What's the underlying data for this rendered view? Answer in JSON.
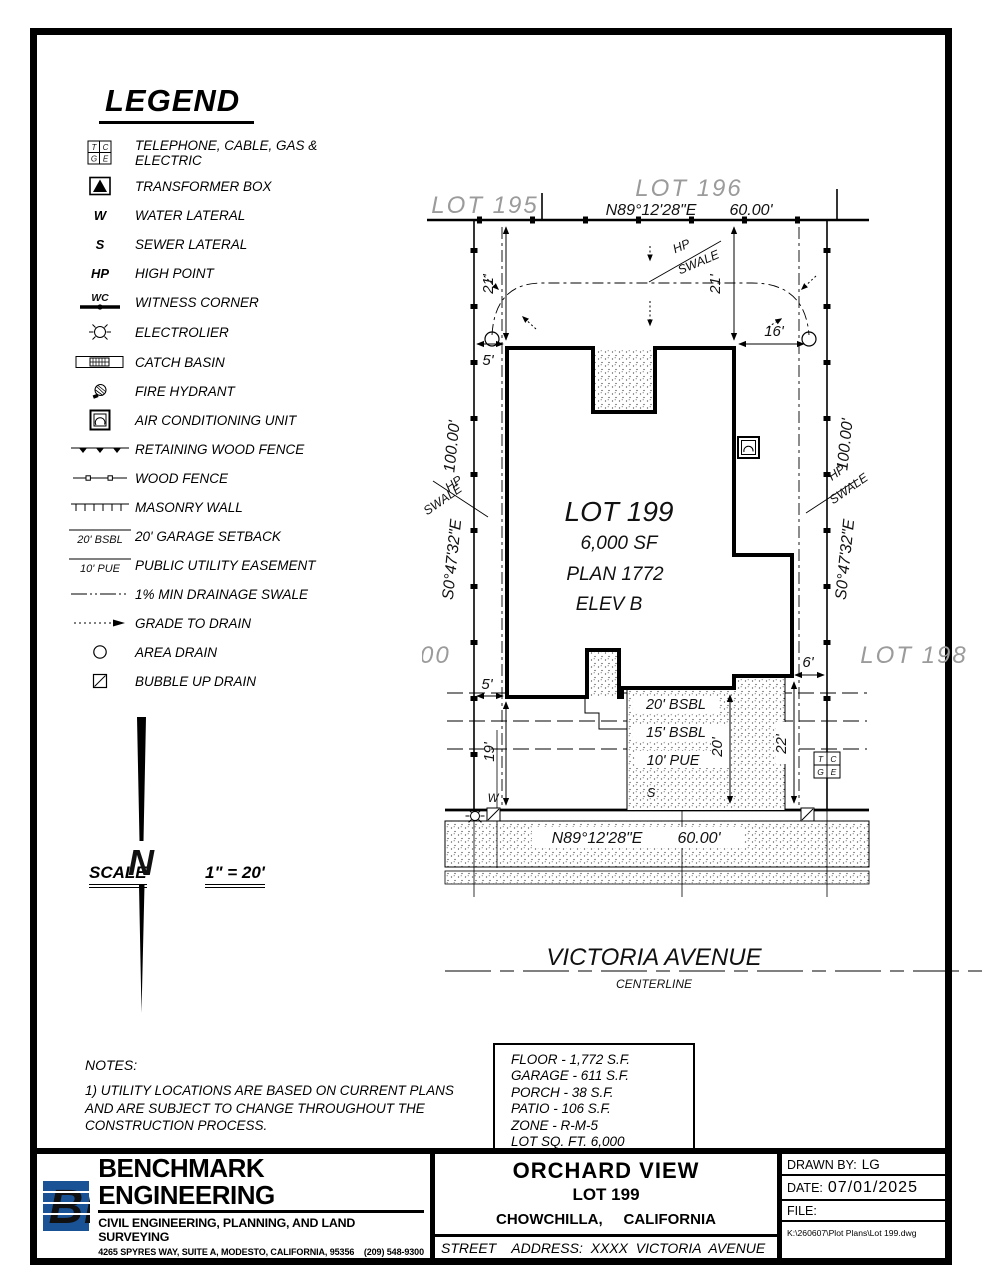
{
  "legend": {
    "title": "LEGEND",
    "sym": {
      "t": "T",
      "c": "C",
      "g": "G",
      "e": "E",
      "w": "W",
      "s": "S",
      "hp": "HP",
      "wc": "WC",
      "bsbl": "20' BSBL",
      "pue": "10' PUE"
    },
    "items": [
      {
        "symbol": "tcge-box-icon",
        "label": "TELEPHONE, CABLE, GAS & ELECTRIC"
      },
      {
        "symbol": "transformer-box-icon",
        "label": "TRANSFORMER BOX"
      },
      {
        "symbol": "water-lateral-icon",
        "label": "WATER LATERAL"
      },
      {
        "symbol": "sewer-lateral-icon",
        "label": "SEWER LATERAL"
      },
      {
        "symbol": "high-point-icon",
        "label": "HIGH POINT"
      },
      {
        "symbol": "witness-corner-icon",
        "label": "WITNESS CORNER"
      },
      {
        "symbol": "electrolier-icon",
        "label": "ELECTROLIER"
      },
      {
        "symbol": "catch-basin-icon",
        "label": "CATCH BASIN"
      },
      {
        "symbol": "fire-hydrant-icon",
        "label": "FIRE HYDRANT"
      },
      {
        "symbol": "ac-unit-icon",
        "label": "AIR CONDITIONING UNIT"
      },
      {
        "symbol": "retaining-wood-fence-icon",
        "label": "RETAINING WOOD FENCE"
      },
      {
        "symbol": "wood-fence-icon",
        "label": "WOOD FENCE"
      },
      {
        "symbol": "masonry-wall-icon",
        "label": "MASONRY WALL"
      },
      {
        "symbol": "garage-setback-icon",
        "label": "20' GARAGE SETBACK"
      },
      {
        "symbol": "pue-icon",
        "label": "PUBLIC UTILITY EASEMENT"
      },
      {
        "symbol": "drainage-swale-icon",
        "label": "1% MIN DRAINAGE SWALE"
      },
      {
        "symbol": "grade-to-drain-icon",
        "label": "GRADE TO DRAIN"
      },
      {
        "symbol": "area-drain-icon",
        "label": "AREA DRAIN"
      },
      {
        "symbol": "bubble-up-drain-icon",
        "label": "BUBBLE UP DRAIN"
      }
    ]
  },
  "scale": {
    "label": "SCALE",
    "value": "1\" = 20'"
  },
  "north": {
    "letter": "N"
  },
  "notes": {
    "title": "NOTES:",
    "n1": "1) UTILITY LOCATIONS ARE BASED ON CURRENT PLANS AND ARE SUBJECT TO CHANGE THROUGHOUT THE CONSTRUCTION PROCESS.",
    "n2": "2) ALL DRAINAGE SWALES AND FINISH GRADING SHALL CONFORM TO F.H.A. STANDARDS."
  },
  "plan": {
    "lots": {
      "l195": "LOT 195",
      "l196": "LOT 196",
      "l198": "LOT 198",
      "l200": "LOT 200"
    },
    "bearing_top": "N89°12'28\"E",
    "dist_top": "60.00'",
    "bearing_bottom": "N89°12'28\"E",
    "dist_bottom": "60.00'",
    "side_bearing": "S0°47'32\"E",
    "side_dist": "100.00'",
    "lot_no": "LOT 199",
    "lot_sf": "6,000 SF",
    "lot_plan": "PLAN 1772",
    "lot_elev": "ELEV B",
    "dims": {
      "left21": "21'",
      "right21": "21'",
      "d16": "16'",
      "top5": "5'",
      "bot5": "5'",
      "d19": "19'",
      "d20": "20'",
      "d22": "22'",
      "d6": "6'"
    },
    "setbacks": {
      "s20": "20' BSBL",
      "s15": "15' BSBL",
      "s10": "10' PUE"
    },
    "hp": "HP",
    "swale": "SWALE",
    "w": "W",
    "s": "S",
    "tcge": {
      "t": "T",
      "c": "C",
      "g": "G",
      "e": "E"
    },
    "street_name": "VICTORIA AVENUE",
    "street_sub": "CENTERLINE"
  },
  "stats": {
    "lines": [
      "FLOOR - 1,772 S.F.",
      "GARAGE - 611 S.F.",
      "PORCH - 38 S.F.",
      "PATIO - 106 S.F.",
      "ZONE - R-M-5",
      "LOT SQ. FT. 6,000",
      "LOT COVERAGE - 40.4%"
    ]
  },
  "titleblock": {
    "logo": "BE",
    "company": "BENCHMARK ENGINEERING",
    "tagline": "CIVIL ENGINEERING, PLANNING, AND LAND SURVEYING",
    "address": "4265 SPYRES WAY, SUITE A, MODESTO, CALIFORNIA, 95356    (209) 548-9300",
    "project": "ORCHARD VIEW",
    "lot": "LOT 199",
    "city": "CHOWCHILLA,     CALIFORNIA",
    "street_address": "STREET    ADDRESS:  XXXX  VICTORIA  AVENUE",
    "drawn_by_label": "DRAWN BY:",
    "drawn_by": "LG",
    "date_label": "DATE:",
    "date": "07/01/2025",
    "file_label": "FILE:",
    "file_path": "K:\\260607\\Plot Plans\\Lot 199.dwg"
  },
  "colors": {
    "logo_blue": "#1a5296",
    "lot_gray": "#9b9b9b"
  }
}
